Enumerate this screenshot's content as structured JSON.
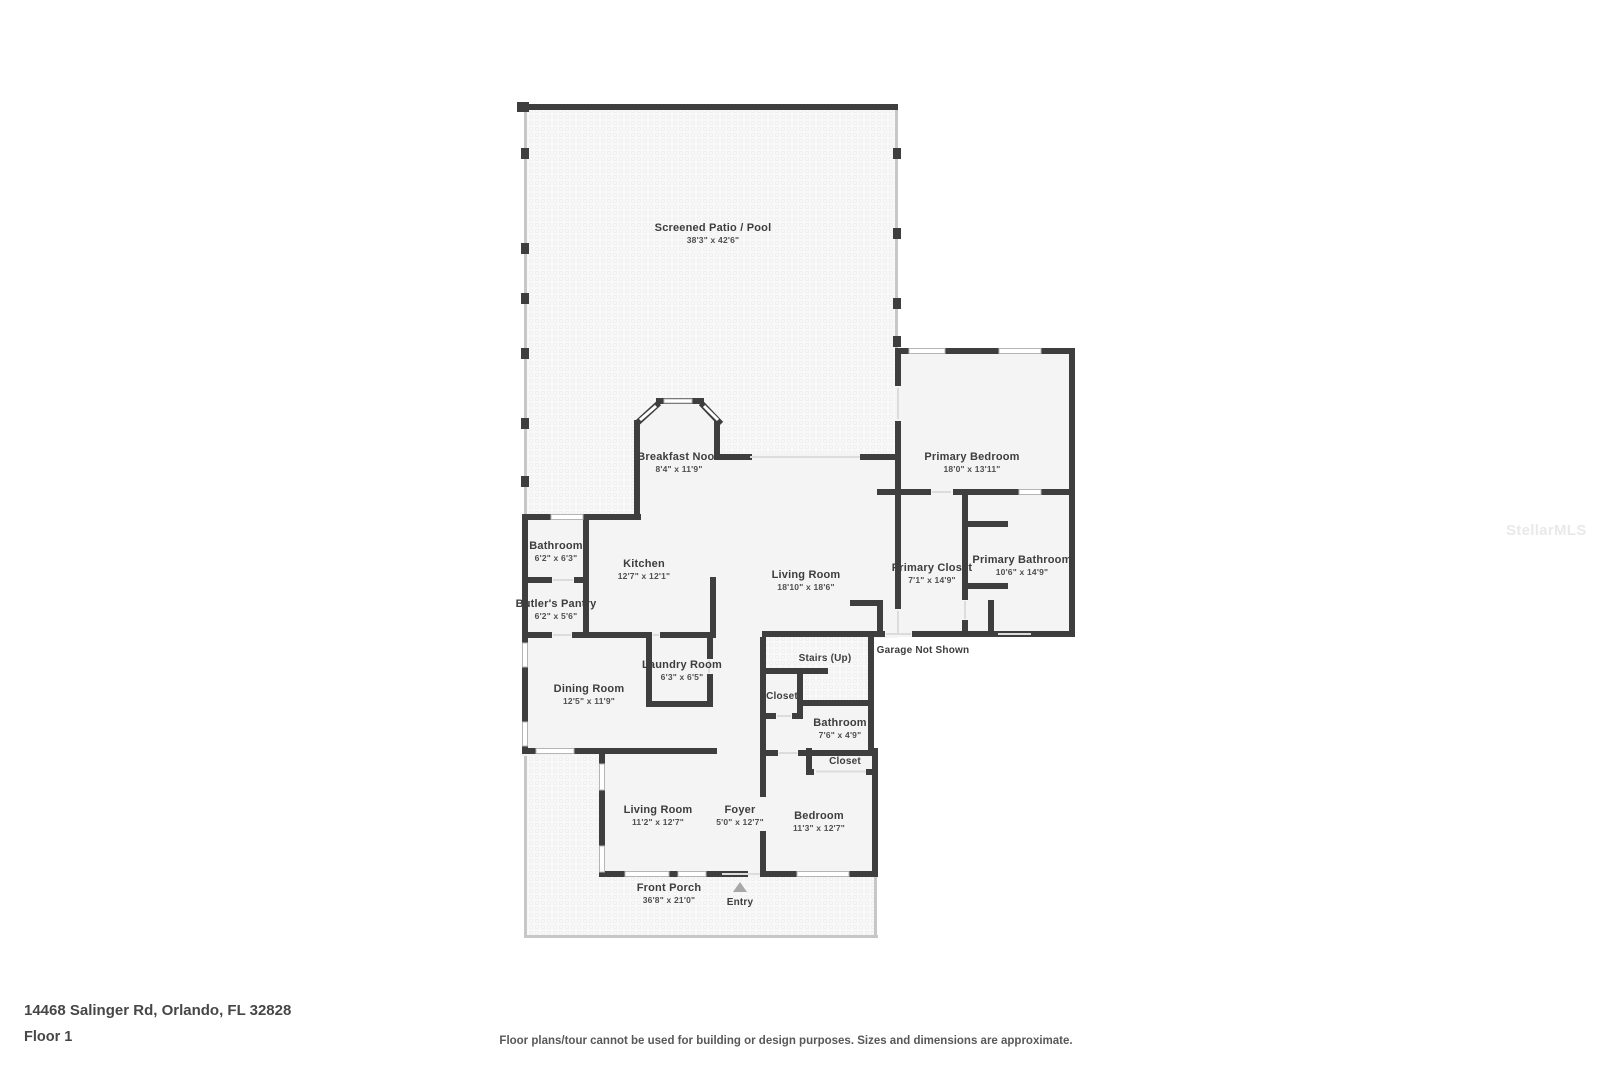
{
  "footer": {
    "address": "14468 Salinger Rd, Orlando, FL 32828",
    "floor_label": "Floor 1",
    "disclaimer": "Floor plans/tour cannot be used for building or design purposes. Sizes and dimensions are approximate."
  },
  "watermark": "StellarMLS",
  "colors": {
    "wall": "#3e3e3e",
    "screen_wall": "#c7c7c7",
    "room_fill": "#f4f4f4",
    "texture_dot": "#e4e4e4",
    "label_text": "#3d3d3d",
    "entry_arrow": "#a8a8a8"
  },
  "rooms": {
    "screened_patio": {
      "name": "Screened Patio / Pool",
      "dims": "38'3\" x 42'6\""
    },
    "breakfast_nook": {
      "name": "Breakfast Nook",
      "dims": "8'4\" x 11'9\""
    },
    "primary_bedroom": {
      "name": "Primary Bedroom",
      "dims": "18'0\" x 13'11\""
    },
    "bathroom_upper": {
      "name": "Bathroom",
      "dims": "6'2\" x 6'3\""
    },
    "kitchen": {
      "name": "Kitchen",
      "dims": "12'7\" x 12'1\""
    },
    "living_room_main": {
      "name": "Living Room",
      "dims": "18'10\" x 18'6\""
    },
    "primary_closet": {
      "name": "Primary Closet",
      "dims": "7'1\" x 14'9\""
    },
    "primary_bathroom": {
      "name": "Primary Bathroom",
      "dims": "10'6\" x 14'9\""
    },
    "butlers_pantry": {
      "name": "Butler's Pantry",
      "dims": "6'2\" x 5'6\""
    },
    "garage_note": {
      "name": "Garage Not Shown"
    },
    "stairs": {
      "name": "Stairs (Up)"
    },
    "laundry_room": {
      "name": "Laundry Room",
      "dims": "6'3\" x 6'5\""
    },
    "closet_hall": {
      "name": "Closet"
    },
    "dining_room": {
      "name": "Dining Room",
      "dims": "12'5\" x 11'9\""
    },
    "bathroom_hall": {
      "name": "Bathroom",
      "dims": "7'6\" x 4'9\""
    },
    "closet_bedroom": {
      "name": "Closet"
    },
    "living_room_front": {
      "name": "Living Room",
      "dims": "11'2\" x 12'7\""
    },
    "foyer": {
      "name": "Foyer",
      "dims": "5'0\" x 12'7\""
    },
    "bedroom": {
      "name": "Bedroom",
      "dims": "11'3\" x 12'7\""
    },
    "front_porch": {
      "name": "Front Porch",
      "dims": "36'8\" x 21'0\""
    },
    "entry": {
      "name": "Entry"
    }
  }
}
